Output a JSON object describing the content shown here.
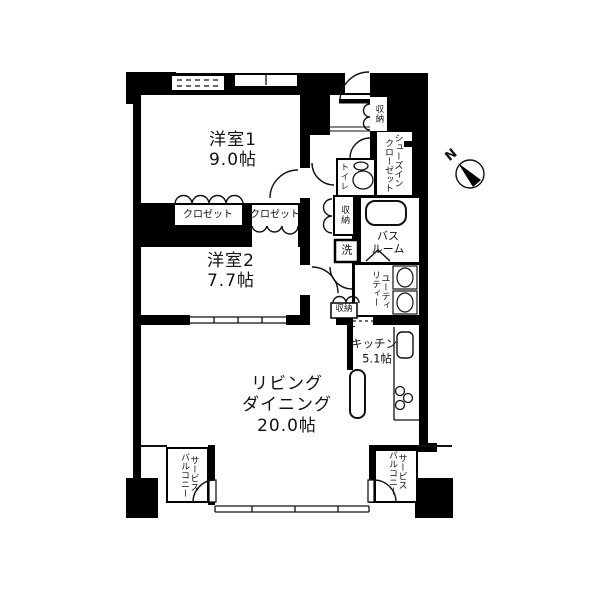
{
  "floorplan": {
    "rooms": {
      "western_room_1": {
        "name": "洋室1",
        "size": "9.0帖"
      },
      "western_room_2": {
        "name": "洋室2",
        "size": "7.7帖"
      },
      "living_dining": {
        "line1": "リビング",
        "line2": "ダイニング",
        "size": "20.0帖"
      },
      "kitchen": {
        "name": "キッチン",
        "size": "5.1帖"
      },
      "bathroom": {
        "line1": "バス",
        "line2": "ルーム"
      },
      "utility": {
        "col_right": "ユーティ",
        "col_left": "リティー"
      },
      "shoes_in_closet": {
        "col_right": "シューズイン",
        "col_left": "クローゼット"
      },
      "toilet": {
        "name": "トイレ"
      },
      "washer": {
        "name": "洗"
      },
      "closet_room1": {
        "name": "クロゼット"
      },
      "closet_room2": {
        "name": "クロゼット"
      },
      "storage_entrance": {
        "name": "収納"
      },
      "storage_hall": {
        "name": "収納"
      },
      "storage_ld": {
        "name": "収納"
      },
      "service_balcony_left": {
        "col_right": "サービス",
        "col_left": "バルコニー"
      },
      "service_balcony_right": {
        "col_right": "サービス",
        "col_left": "バルコニー"
      }
    },
    "compass": {
      "label": "N"
    },
    "colors": {
      "wall": "#000000",
      "background": "#ffffff",
      "line": "#111111"
    }
  }
}
